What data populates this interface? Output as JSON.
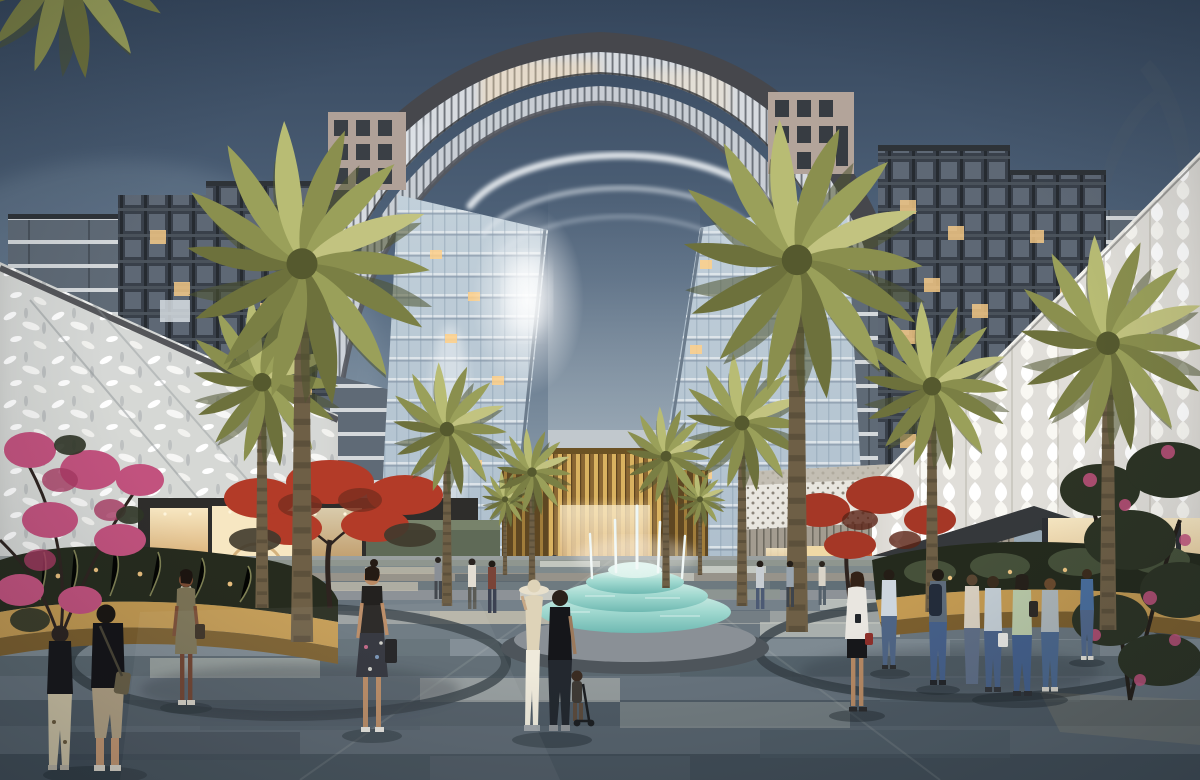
{
  "scene": {
    "type": "architectural rendering photograph",
    "setting": "mixed-use retail plaza promenade at dusk",
    "landmark": "arch-shaped residential tower block",
    "features": [
      "arch tower",
      "palm trees",
      "tiered fountain",
      "perforated white retail facades",
      "gold slat pavilion",
      "striped stone paving",
      "pedestrians",
      "flowering trees",
      "planters"
    ]
  },
  "palette": {
    "sky_top": "#35465c",
    "sky_mid": "#54687f",
    "sky_horizon": "#aebdc6",
    "sun_glow": "#ffffff",
    "arch_frame": "#46474c",
    "arch_louver": "#d7dbe0",
    "glass_cool": "#aebfcd",
    "window_warm": "#ffd089",
    "facade_white": "#e8e6df",
    "gold_slat": "#d9b260",
    "gold_deep": "#8a6733",
    "fountain_aqua": "#9fd8cf",
    "fountain_deep": "#6fb9b2",
    "paving_light": "#9aa0a0",
    "paving_mid": "#6e7a80",
    "paving_dark": "#414d57",
    "planter_gold": "#c39a52",
    "palm_green": "#8a8f4e",
    "palm_shadow": "#4f5530",
    "flower_pink": "#c2527e",
    "flower_red": "#b33b28"
  }
}
